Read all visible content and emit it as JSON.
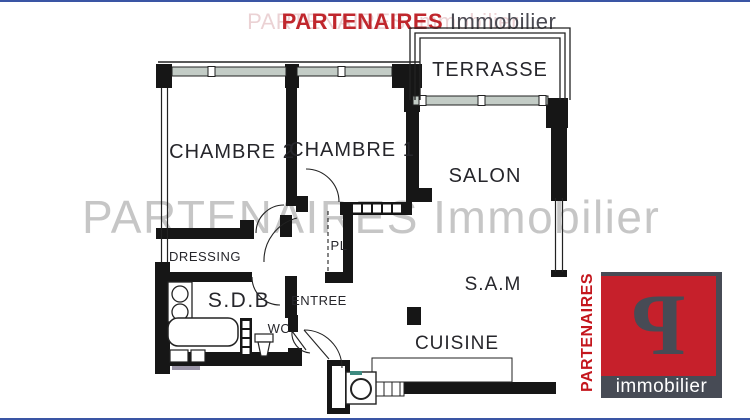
{
  "page": {
    "edge_line_color": "#3a55a4",
    "background": "#ffffff"
  },
  "header": {
    "brand": "PARTENAIRES",
    "suffix": "Immobilier",
    "brand_color": "#c0272d",
    "suffix_color": "#4a4a52",
    "ghost_text": "PARTENAIRES Immobilier"
  },
  "watermark": {
    "text": "PARTENAIRES Immobilier",
    "color": "#b9b9b9"
  },
  "floorplan": {
    "wall_color": "#161616",
    "window_band_color": "#c3ccc6",
    "rooms": {
      "terrasse": "TERRASSE",
      "chambre2": "CHAMBRE 2",
      "chambre1": "CHAMBRE 1",
      "salon": "SALON",
      "sam": "S.A.M",
      "cuisine": "CUISINE",
      "dressing": "DRESSING",
      "sdb": "S.D.B",
      "entree": "ENTREE",
      "wc": "WC",
      "pl": "PL"
    }
  },
  "logo": {
    "vertical_text": "PARTENAIRES",
    "glyph": "P",
    "bottom_text": "immobilier",
    "red": "#c6202b",
    "slate": "#474b55"
  }
}
